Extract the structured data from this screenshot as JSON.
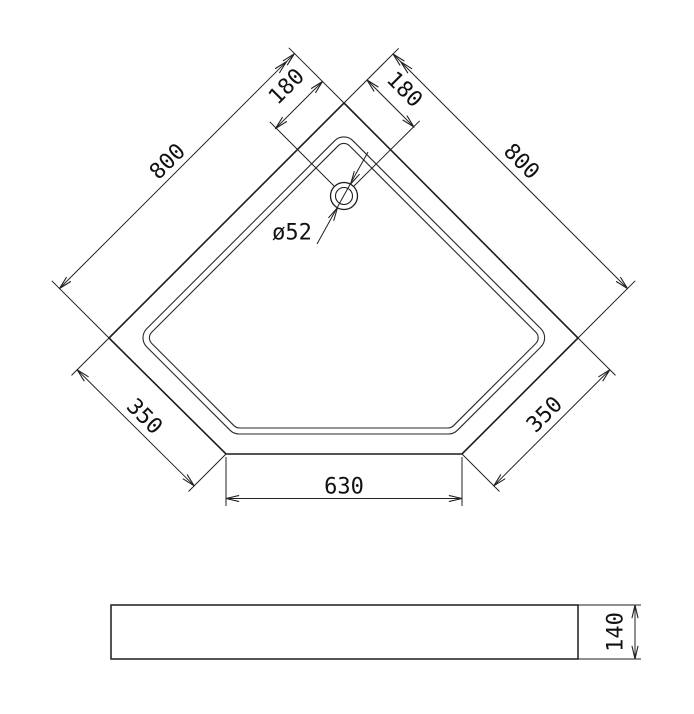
{
  "colors": {
    "background": "#ffffff",
    "outline": "#1c1c1c",
    "rim": "#2a2a2a",
    "dimension_line": "#222222",
    "text": "#111111"
  },
  "drawing": {
    "canvas": {
      "width": 694,
      "height": 714
    },
    "plan_view": {
      "outline_points": [
        [
          344,
          103
        ],
        [
          578,
          338
        ],
        [
          462,
          454
        ],
        [
          226,
          454
        ],
        [
          109,
          338
        ]
      ],
      "rim_outer": {
        "points": [
          [
            343.8,
            131.6
          ],
          [
            550,
            337.8
          ],
          [
            453.7,
            434
          ],
          [
            233.8,
            434
          ],
          [
            137.6,
            337.8
          ]
        ],
        "corner_radius": 13
      },
      "rim_inner": {
        "points": [
          [
            343.8,
            140.1
          ],
          [
            541.5,
            337.8
          ],
          [
            451.2,
            428
          ],
          [
            236.3,
            428
          ],
          [
            146.1,
            337.8
          ]
        ],
        "corner_radius": 8
      },
      "drain": {
        "cx": 344,
        "cy": 196,
        "outer_r": 13.5,
        "inner_r": 8.5
      }
    },
    "side_view": {
      "x": 111,
      "y": 605,
      "width": 467,
      "height": 54
    },
    "arrow_style": {
      "length": 13,
      "half_angle_deg": 13
    },
    "dimensions": [
      {
        "id": "800-left",
        "label": "800",
        "line": [
          [
            59.5,
            288.5
          ],
          [
            294.3,
            53.8
          ]
        ],
        "arrows": [
          {
            "tip": [
              59.5,
              288.5
            ],
            "angle": 135
          },
          {
            "tip": [
              294.3,
              53.8
            ],
            "angle": -45
          },
          {
            "tip": [
              286.5,
              61.6
            ],
            "angle": -45
          }
        ],
        "extensions": [
          [
            [
              109,
              338
            ],
            [
              51.8,
              280.8
            ]
          ],
          [
            [
              344,
              103
            ],
            [
              288.8,
              47.8
            ]
          ]
        ],
        "text": {
          "x": 168,
          "y": 162,
          "rotate": -45
        }
      },
      {
        "id": "800-right",
        "label": "800",
        "line": [
          [
            393,
            54
          ],
          [
            627.5,
            288.5
          ]
        ],
        "arrows": [
          {
            "tip": [
              627.5,
              288.5
            ],
            "angle": 45
          },
          {
            "tip": [
              393,
              54
            ],
            "angle": -135
          },
          {
            "tip": [
              400.8,
              61.8
            ],
            "angle": -135
          }
        ],
        "extensions": [
          [
            [
              578,
              338
            ],
            [
              635.2,
              280.8
            ]
          ],
          [
            [
              344,
              103
            ],
            [
              398.7,
              48.3
            ]
          ]
        ],
        "text": {
          "x": 521,
          "y": 162,
          "rotate": 45
        }
      },
      {
        "id": "180-left",
        "label": "180",
        "line": [
          [
            275.5,
            128.5
          ],
          [
            322.5,
            81.5
          ]
        ],
        "arrows": [
          {
            "tip": [
              275.5,
              128.5
            ],
            "angle": 135
          },
          {
            "tip": [
              322.5,
              81.5
            ],
            "angle": -45
          }
        ],
        "extensions": [
          [
            [
              334.5,
              186.5
            ],
            [
              269.8,
              121.8
            ]
          ]
        ],
        "text": {
          "x": 287,
          "y": 87,
          "rotate": -45
        }
      },
      {
        "id": "180-right",
        "label": "180",
        "line": [
          [
            367,
            80
          ],
          [
            414,
            127
          ]
        ],
        "arrows": [
          {
            "tip": [
              367,
              80
            ],
            "angle": -135
          },
          {
            "tip": [
              414,
              127
            ],
            "angle": 45
          }
        ],
        "extensions": [
          [
            [
              353.5,
              186.5
            ],
            [
              419.7,
              120.8
            ]
          ]
        ],
        "text": {
          "x": 404,
          "y": 90,
          "rotate": 45
        }
      },
      {
        "id": "drain-diameter",
        "label": "ø52",
        "line": [
          [
            317,
            244
          ],
          [
            368,
            152
          ]
        ],
        "arrows": [
          {
            "tip": [
              337.4,
              207.9
            ],
            "angle": -61
          },
          {
            "tip": [
              350.6,
              184.1
            ],
            "angle": 119
          }
        ],
        "extensions": [],
        "text": {
          "x": 292,
          "y": 233,
          "rotate": 0
        }
      },
      {
        "id": "350-left",
        "label": "350",
        "line": [
          [
            77.2,
            369.8
          ],
          [
            194.2,
            485.8
          ]
        ],
        "arrows": [
          {
            "tip": [
              77.2,
              369.8
            ],
            "angle": -135
          },
          {
            "tip": [
              194.2,
              485.8
            ],
            "angle": 45
          }
        ],
        "extensions": [
          [
            [
              109,
              338
            ],
            [
              71.5,
              375.4
            ]
          ],
          [
            [
              226,
              454
            ],
            [
              188.5,
              491.5
            ]
          ]
        ],
        "text": {
          "x": 144,
          "y": 417,
          "rotate": 45
        }
      },
      {
        "id": "350-right",
        "label": "350",
        "line": [
          [
            609.8,
            369.8
          ],
          [
            493.8,
            485.8
          ]
        ],
        "arrows": [
          {
            "tip": [
              609.8,
              369.8
            ],
            "angle": -45
          },
          {
            "tip": [
              493.8,
              485.8
            ],
            "angle": 135
          }
        ],
        "extensions": [
          [
            [
              578,
              338
            ],
            [
              615.5,
              375.4
            ]
          ],
          [
            [
              462,
              454
            ],
            [
              499.5,
              491.5
            ]
          ]
        ],
        "text": {
          "x": 545,
          "y": 415,
          "rotate": -45
        }
      },
      {
        "id": "630",
        "label": "630",
        "line": [
          [
            226,
            498.5
          ],
          [
            462,
            498.5
          ]
        ],
        "arrows": [
          {
            "tip": [
              226,
              498.5
            ],
            "angle": 180
          },
          {
            "tip": [
              462,
              498.5
            ],
            "angle": 0
          }
        ],
        "extensions": [
          [
            [
              226,
              457
            ],
            [
              226,
              506
            ]
          ],
          [
            [
              462,
              457
            ],
            [
              462,
              506
            ]
          ]
        ],
        "text": {
          "x": 344,
          "y": 487,
          "rotate": 0
        }
      },
      {
        "id": "140",
        "label": "140",
        "line": [
          [
            635,
            605
          ],
          [
            635,
            659
          ]
        ],
        "arrows": [
          {
            "tip": [
              635,
              605
            ],
            "angle": -90
          },
          {
            "tip": [
              635,
              659
            ],
            "angle": 90
          }
        ],
        "extensions": [
          [
            [
              578,
              605
            ],
            [
              641,
              605
            ]
          ],
          [
            [
              578,
              659
            ],
            [
              641,
              659
            ]
          ]
        ],
        "text": {
          "x": 616,
          "y": 632,
          "rotate": -90
        }
      }
    ]
  }
}
